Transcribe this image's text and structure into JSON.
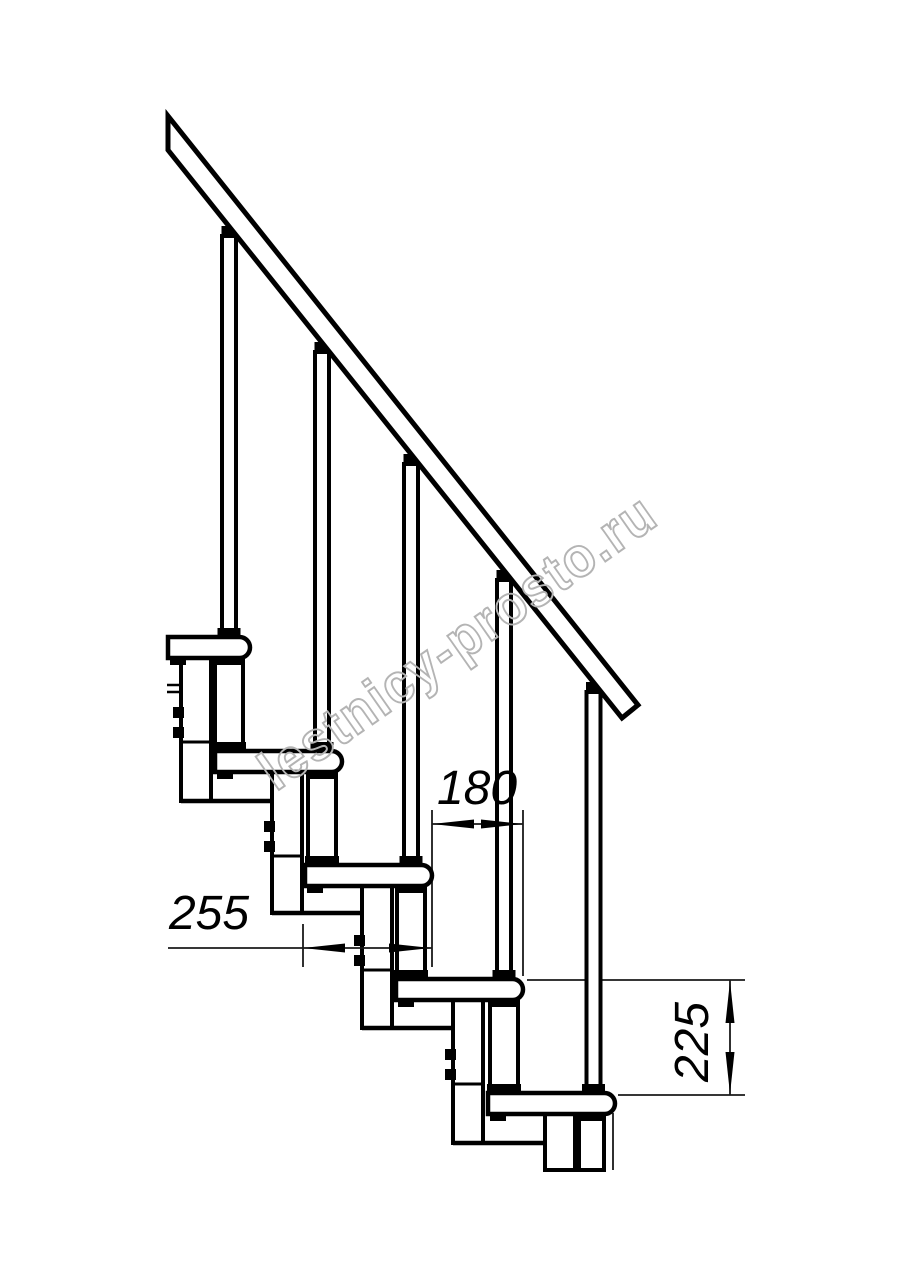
{
  "figure": {
    "kind": "staircase-side-elevation-technical-drawing",
    "steps_visible": 5,
    "background": "#ffffff",
    "ink_color": "#000000",
    "thin_line_color": "#1a1a1a"
  },
  "watermark": {
    "text": "lestnicy-prosto.ru",
    "color": "#b4b4b4"
  },
  "dimensions": {
    "run": {
      "label": "180",
      "value": 180,
      "orientation": "horizontal"
    },
    "tread_depth": {
      "label": "255",
      "value": 255,
      "orientation": "horizontal"
    },
    "rise": {
      "label": "225",
      "value": 225,
      "orientation": "vertical"
    }
  }
}
